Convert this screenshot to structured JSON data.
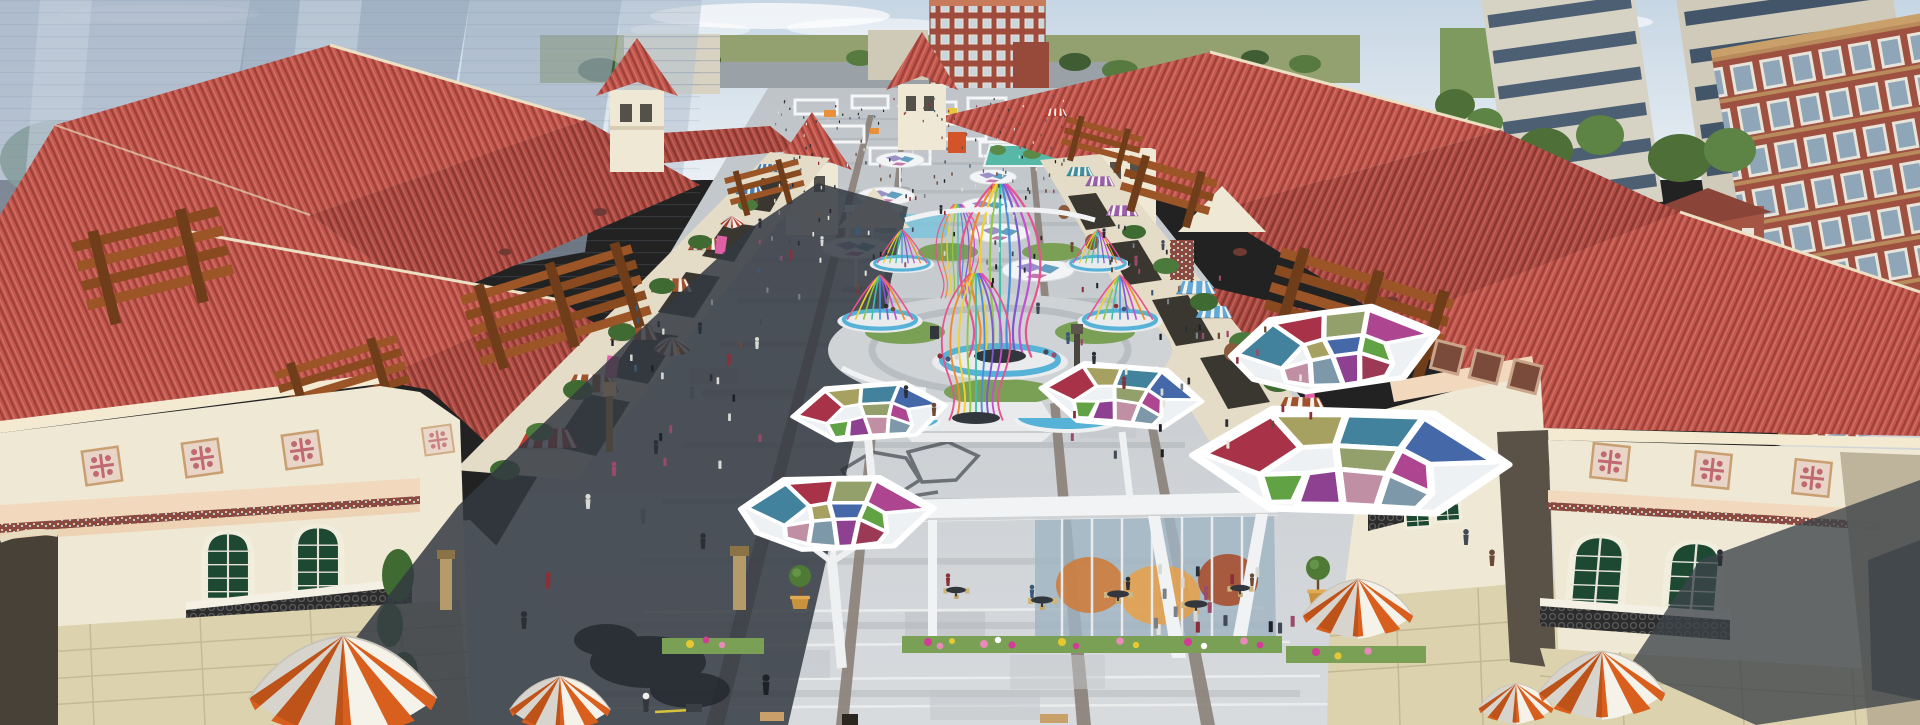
{
  "meta": {
    "type": "3d-architectural-rendering",
    "subject": "Aerial view of a Mediterranean-style outlet shopping village: red-tile-roof buildings flanking a pedestrian plaza with colorful stained-glass canopies, ribbon birdcage fountains, striped dome umbrellas and crowds"
  },
  "palette": {
    "sky_top": "#c7d6e4",
    "sky_low": "#e9eff4",
    "ghost_tower": "#9fb0c4",
    "ghost_tower_light": "#c6d1dd",
    "tower_beige": "#d3cfc0",
    "window_band": "#46586a",
    "brick": "#9e5140",
    "brick_dark": "#7a3a2e",
    "field_green": "#93a070",
    "roof_red": "#c4574d",
    "roof_red_dark": "#ae4a41",
    "ridge_cream": "#ecdfc4",
    "wall_cream": "#efe8d4",
    "wall_cream_shade": "#ddd3b8",
    "wall_stone": "#dcd2ae",
    "storefront_dark": "#3a3630",
    "pergola_brown": "#9c5526",
    "pergola_brown_dark": "#6f3d1a",
    "awning_rust": "#a0522d",
    "awning_blue": "#4a7fb5",
    "awning_red": "#c23b2e",
    "awning_purple": "#9a5fa8",
    "awning_skyblue": "#62a8d8",
    "umbrella_orange": "#d95f1e",
    "umbrella_brown": "#8a5a3a",
    "plaza_light": "#ced2d6",
    "plaza_band": "#a9aeb3",
    "joint_brown": "#8a8178",
    "shadow_dark": "#343a42",
    "grass": "#79a055",
    "foliage": "#3f6b33",
    "water": "#56b2d6",
    "flower_magenta": "#d23c96",
    "flower_pink": "#e88ab8",
    "flower_yellow": "#e8c832",
    "window_green": "#1d4832",
    "iron_dark": "#2c2c2c",
    "pink_tile_bg": "#e8d5c8",
    "pink_tile_motif": "#c06a70",
    "canopy_crimson": "#a83248",
    "canopy_olive": "#a6a161",
    "canopy_teal": "#42829c",
    "canopy_blue": "#4468a8",
    "canopy_sage": "#93a06b",
    "canopy_magenta": "#ad4590",
    "canopy_green": "#61a244",
    "canopy_purple": "#8d4190",
    "canopy_dustypink": "#c18fa4",
    "canopy_slate": "#7d98a8",
    "ribbon_colors": [
      "#e8538f",
      "#f08a2a",
      "#f2d02e",
      "#8fc842",
      "#3fbfae",
      "#4a90d9",
      "#7a5ad0",
      "#c44fd0"
    ]
  },
  "scene": {
    "landmarks": [
      "translucent high-rise towers (background left)",
      "beige apartment towers and red-brick block (background right)",
      "mediterranean towers with pyramid roofs",
      "stained-glass hexagonal canopies (5)",
      "ribbon birdcage fountain cluster",
      "glass cafe pavilion with terrace seating",
      "orange-and-white striped dome umbrellas",
      "striped shop awnings and timber pergolas",
      "flower beds and topiary planters",
      "pedestrian crowds on paved plaza"
    ],
    "crowd": {
      "colors": [
        "#2b2f36",
        "#414a54",
        "#8a3038",
        "#d8d8d4",
        "#3c5878",
        "#6a4a34",
        "#1e2228",
        "#7a8088",
        "#9a4a6a",
        "#e8e4da"
      ],
      "regions": [
        {
          "name": "far-promenade",
          "x": [
            775,
            1065
          ],
          "y": [
            96,
            200
          ],
          "count": 130
        },
        {
          "name": "mid-plaza",
          "x": [
            755,
            1145
          ],
          "y": [
            200,
            300
          ],
          "count": 55
        },
        {
          "name": "left-walk",
          "x": [
            610,
            770
          ],
          "y": [
            305,
            480
          ],
          "count": 22
        },
        {
          "name": "right-walk",
          "x": [
            1060,
            1320
          ],
          "y": [
            250,
            470
          ],
          "count": 38
        },
        {
          "name": "cafe-terrace",
          "x": [
            1150,
            1300
          ],
          "y": [
            570,
            640
          ],
          "count": 16
        }
      ]
    }
  }
}
